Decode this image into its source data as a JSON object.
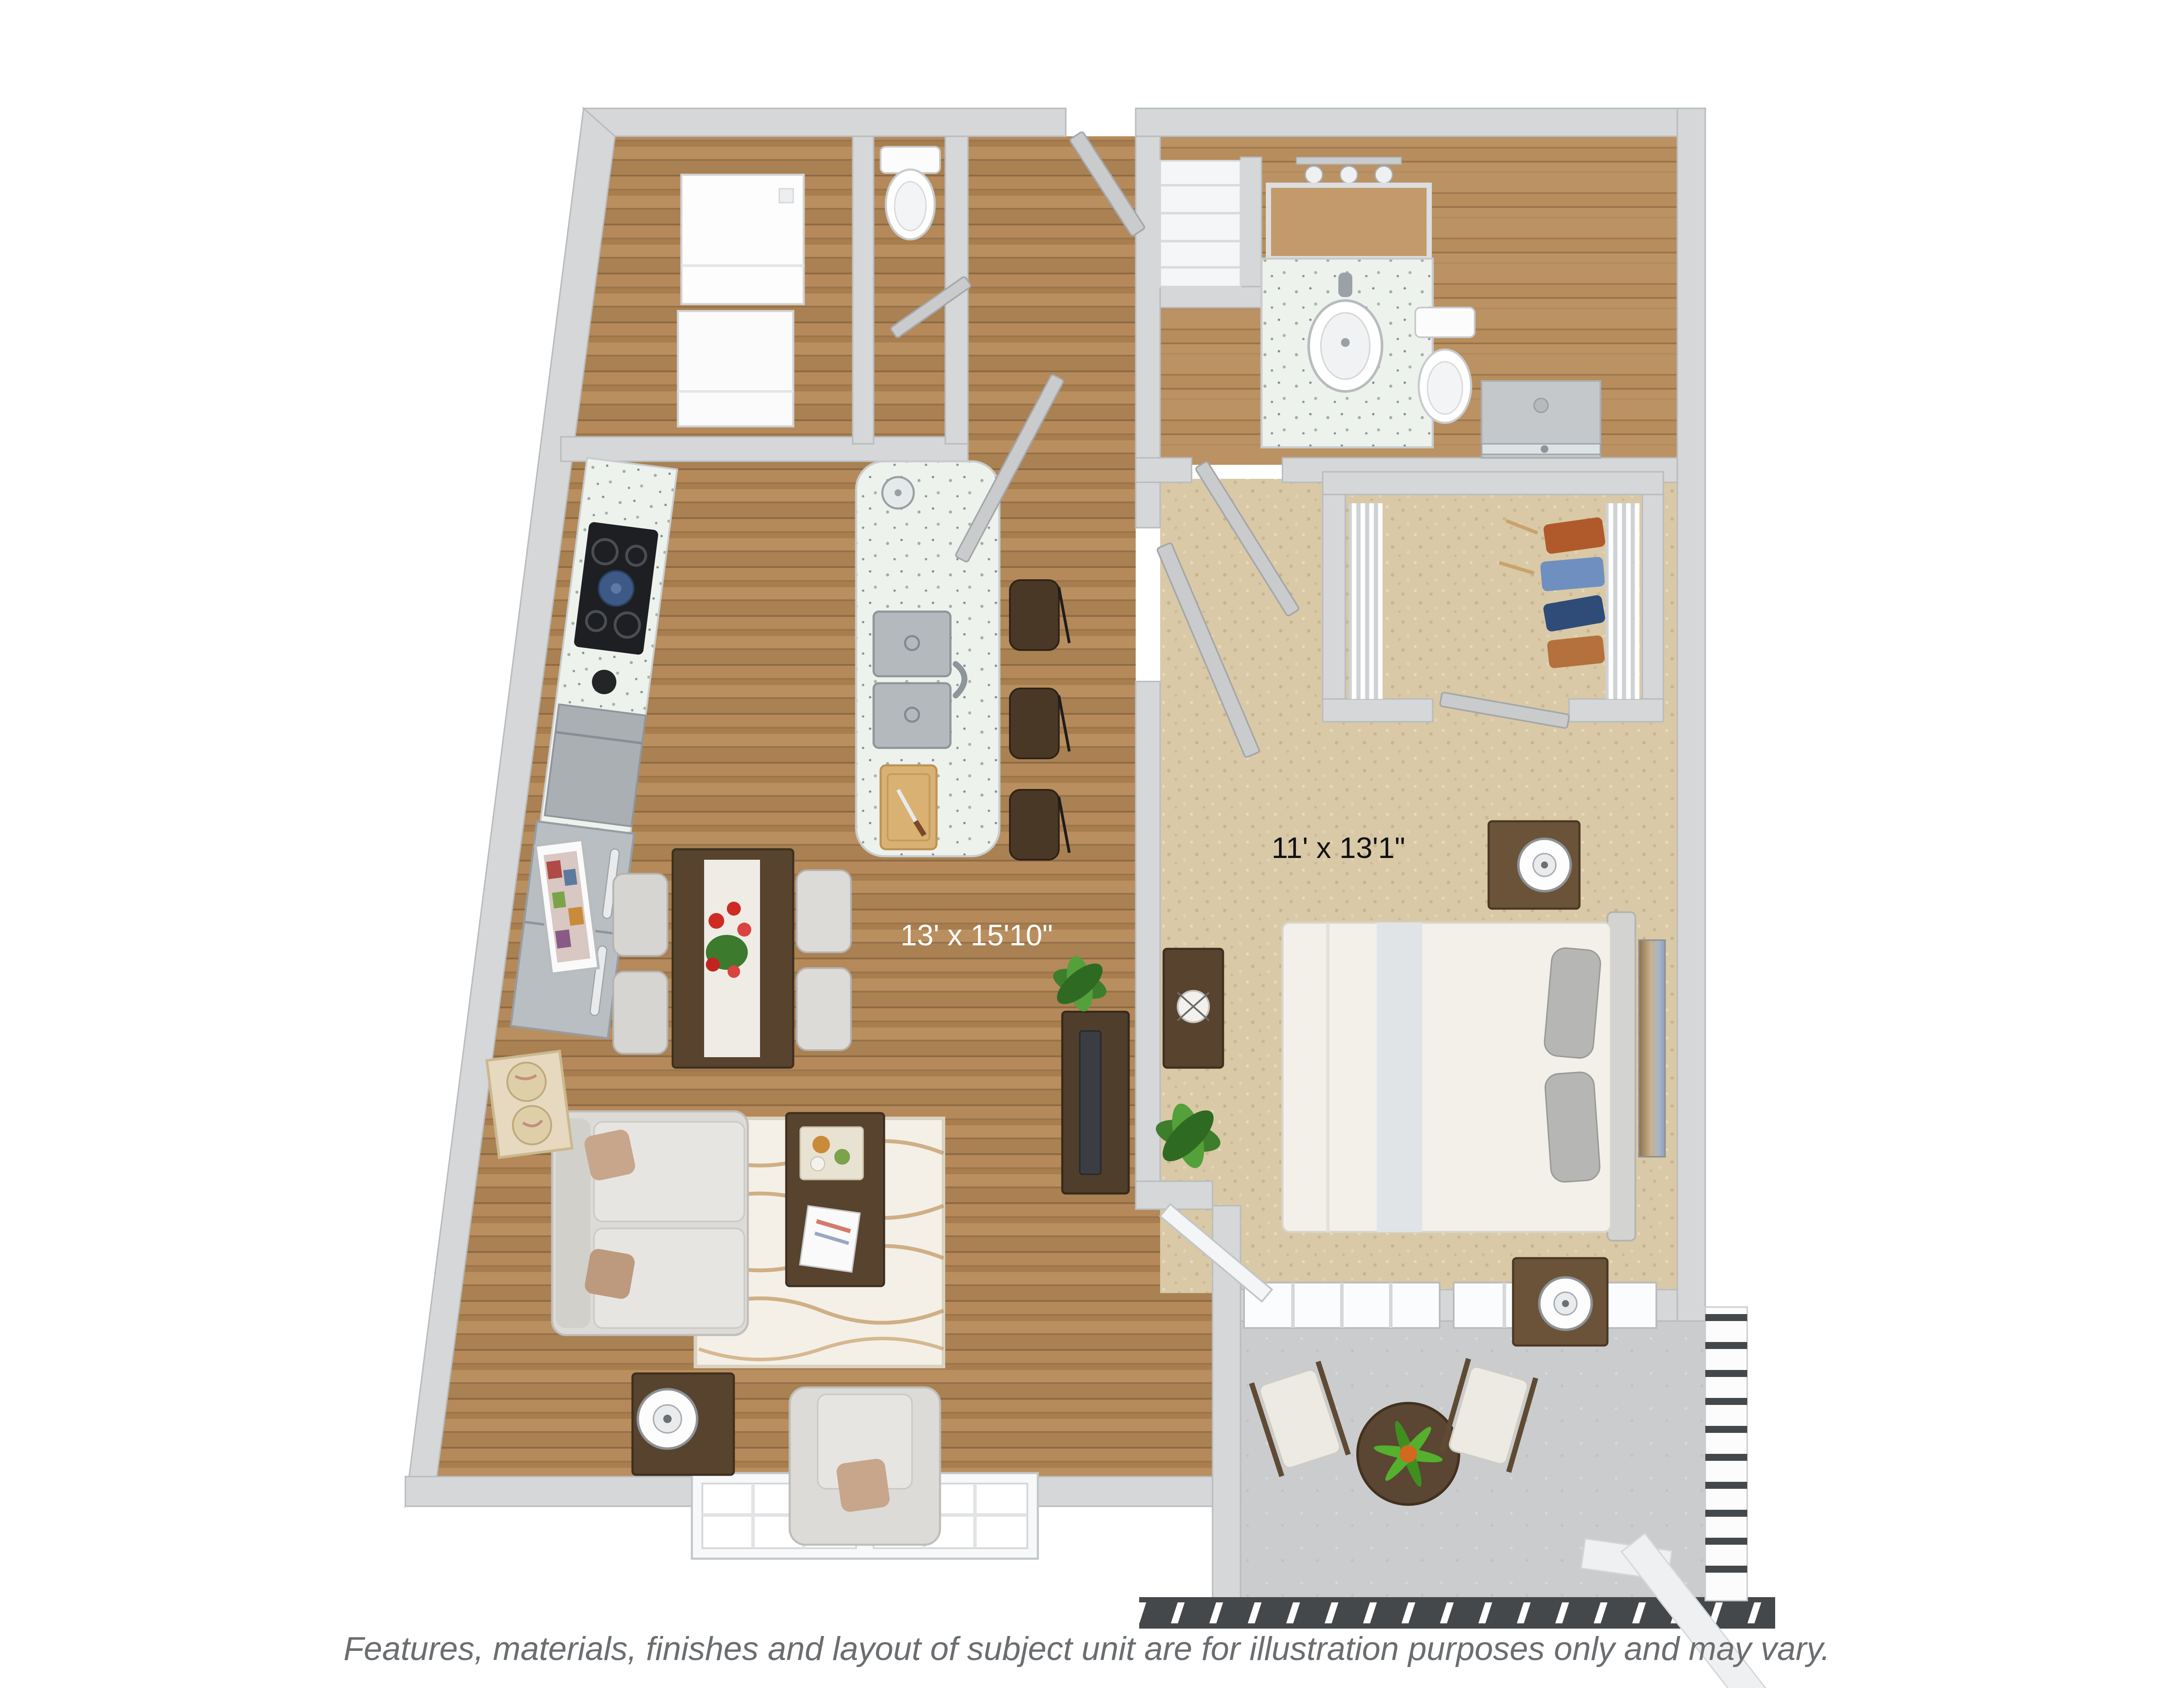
{
  "floorplan": {
    "kind": "3d-apartment-floor-plan",
    "living_room_label": "13' x 15'10\"",
    "bedroom_label": "11' x 13'1\"",
    "disclaimer": "Features, materials, finishes and layout of subject unit are for illustration purposes only and may vary.",
    "colors": {
      "background": "#ffffff",
      "wall": "#d5d7d9",
      "wall_stroke": "#b9bcbe",
      "wood_floor": "#b08757",
      "carpet": "#d9c9a7",
      "balcony_floor": "#caccce",
      "counter_speckled": "#eef2ed",
      "stainless": "#b4b9bd",
      "cooktop_black": "#1d1f22",
      "kettle_blue": "#3d5a86",
      "furniture_dark_wood": "#57432e",
      "sofa_gray": "#dcdbd7",
      "pillow_tan": "#c7a68b",
      "rug_cream": "#f4f0e7",
      "rug_wave": "#c79f6e",
      "accent_flower_red": "#cf2b25",
      "plant_green": "#4d8f33",
      "railing_dark": "#45484b",
      "living_label_color": "#ffffff",
      "bedroom_label_color": "#121212",
      "disclaimer_color": "#6b6e71"
    }
  }
}
